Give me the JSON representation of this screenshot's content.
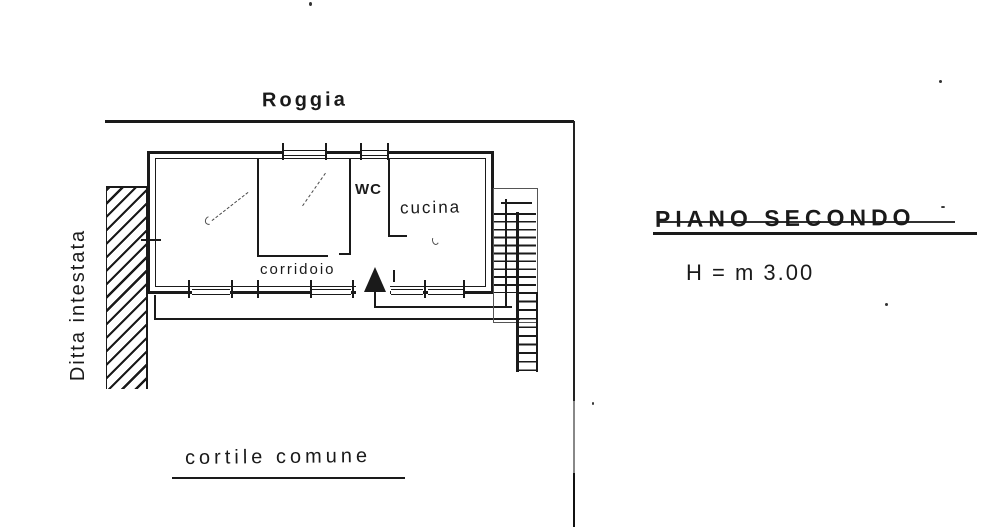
{
  "plan": {
    "north_boundary": "Roggia",
    "west_boundary": "Ditta intestata",
    "courtyard": "cortile comune",
    "floor_title": "PIANO SECONDO",
    "floor_height": "H = m 3.00",
    "rooms": {
      "wc": "WC",
      "kitchen": "cucina",
      "corridor": "corridoio"
    }
  },
  "colors": {
    "ink": "#1a1a1a",
    "pencil": "#4a4a4a",
    "paper": "#ffffff"
  }
}
